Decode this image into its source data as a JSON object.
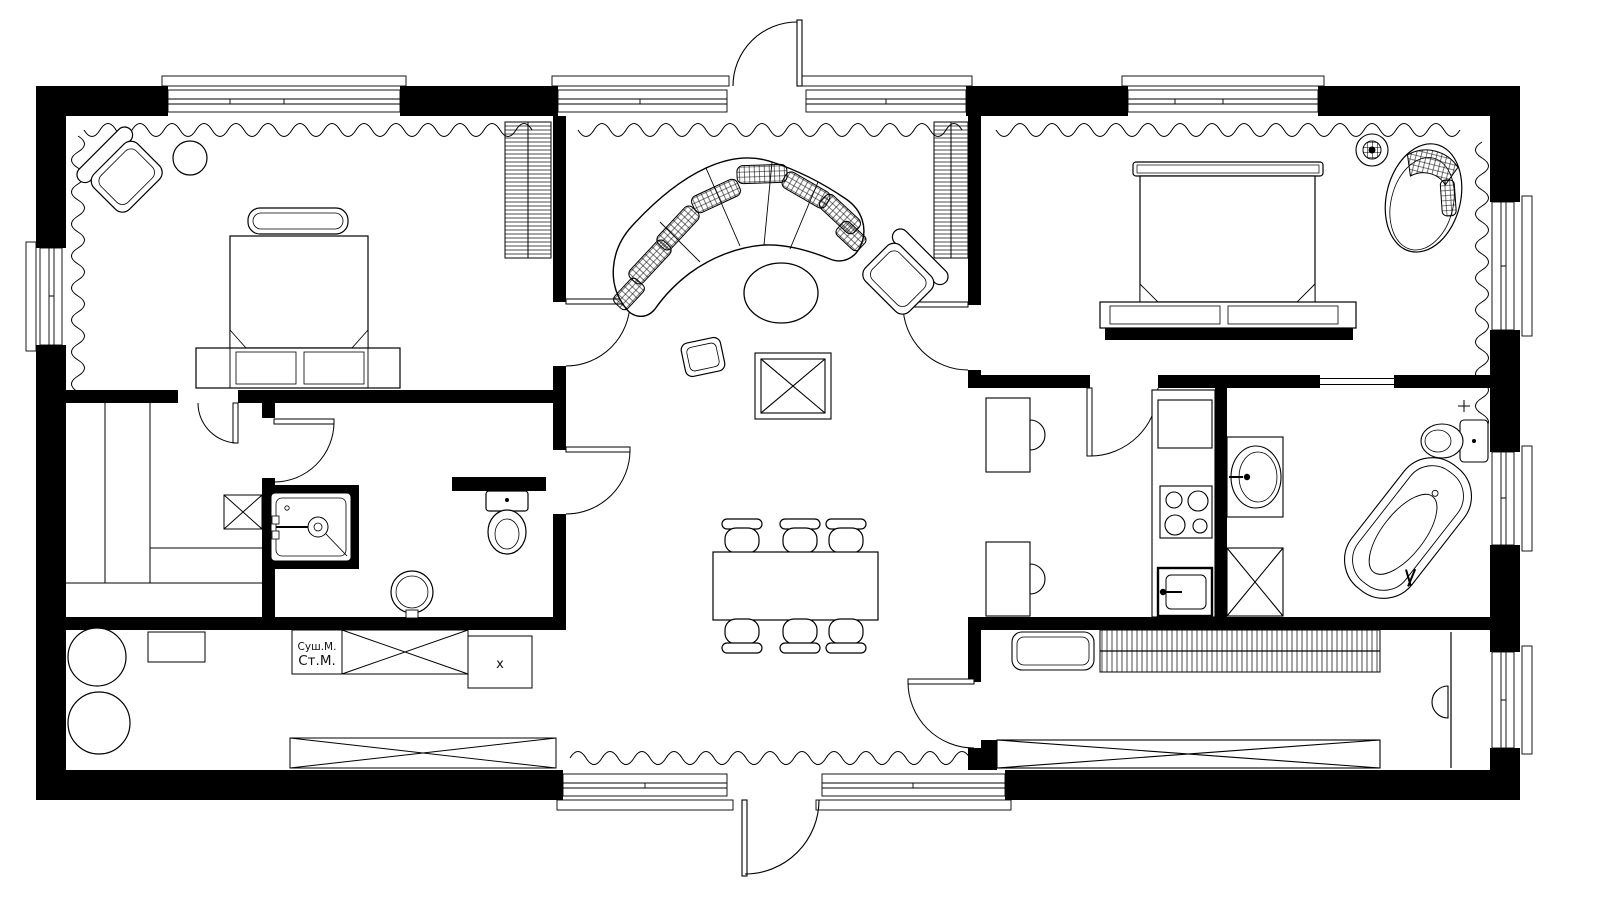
{
  "plan": {
    "background": "#ffffff",
    "wall_color": "#000000",
    "line_color": "#000000",
    "labels": {
      "dryer": "Суш.М.",
      "washer": "Ст.М.",
      "cabinet_mark": "x"
    }
  }
}
